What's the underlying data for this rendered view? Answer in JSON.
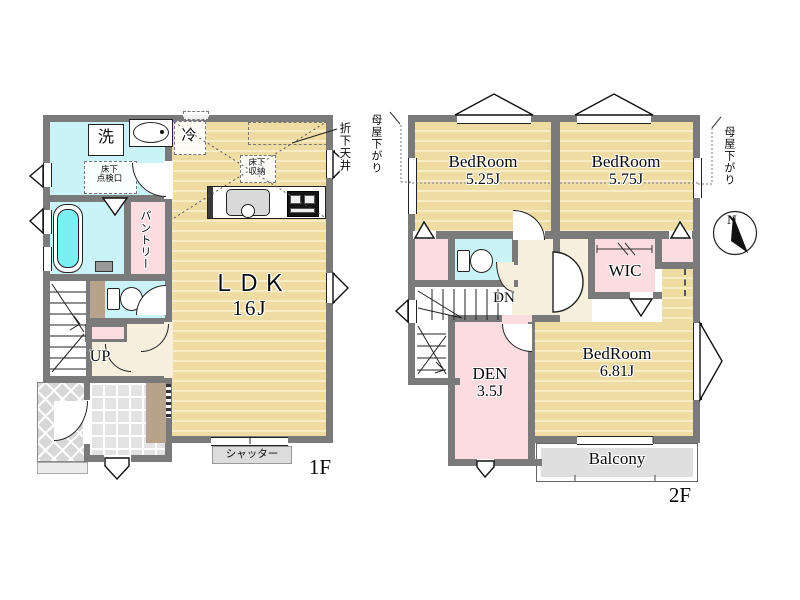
{
  "title": "floor-plan",
  "colors": {
    "wall": "#7a7a7a",
    "tatami_floor": "#eedca2",
    "wet_room": "#c9f3f6",
    "storage_pink": "#fbdce0",
    "hallway": "#f6efde",
    "balcony_gray": "#dfdfdf",
    "step_brown": "#b7a28c"
  },
  "floor1": {
    "floor_label": "1F",
    "ldk": {
      "name": "ＬＤＫ",
      "size": "16J"
    },
    "laundry_machine": "洗",
    "refrigerator": "冷",
    "pantry": "パントリー",
    "underfloor_inspection": {
      "line1": "床下",
      "line2": "点検口"
    },
    "underfloor_storage": {
      "line1": "床下",
      "line2": "収納"
    },
    "dropped_ceiling": "折下天井",
    "stairs": "UP",
    "shutter": "シャッター"
  },
  "floor2": {
    "floor_label": "2F",
    "bedroom_a": {
      "name": "BedRoom",
      "size": "5.25J"
    },
    "bedroom_b": {
      "name": "BedRoom",
      "size": "5.75J"
    },
    "bedroom_c": {
      "name": "BedRoom",
      "size": "6.81J"
    },
    "den": {
      "name": "DEN",
      "size": "3.5J"
    },
    "wic": "WIC",
    "stairs": "DN",
    "balcony": "Balcony",
    "roof_slope_left": "母屋下がり",
    "roof_slope_right": "母屋下がり",
    "compass_north": "N"
  }
}
